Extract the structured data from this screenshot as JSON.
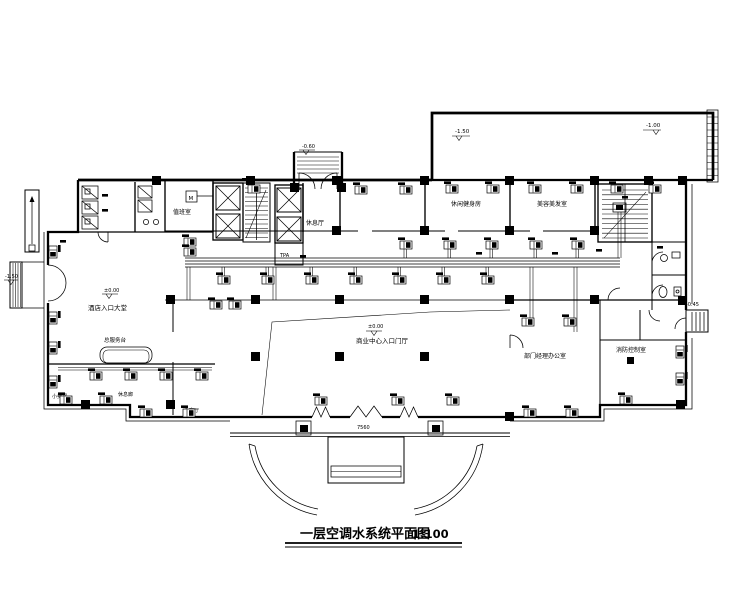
{
  "title": {
    "text": "一层空调水系统平面图",
    "scale": "1:100"
  },
  "elevations": {
    "terrace_left": "-1.50",
    "terrace_right": "-1.00",
    "lobby": "±0.00",
    "hall": "±0.00",
    "vestibule": "-0.60",
    "side_entrance": "-0.45",
    "left_steps": "-1.50"
  },
  "rooms": {
    "lobby": "酒店入口大堂",
    "hall": "商业中心入口门厅",
    "duty": "值班室",
    "rest": "休息厅",
    "fitness": "休闲健身房",
    "beauty": "美容美发室",
    "service_desk": "总服务台",
    "shop": "小卖部",
    "lounge": "休息廊",
    "meeting": "会客厅",
    "manager": "部门经理办公室",
    "fire_control": "消防控制室"
  },
  "labels": {
    "equipment": "TPA",
    "duty_box": "M"
  },
  "dimensions": {
    "porch_width": "7560"
  }
}
